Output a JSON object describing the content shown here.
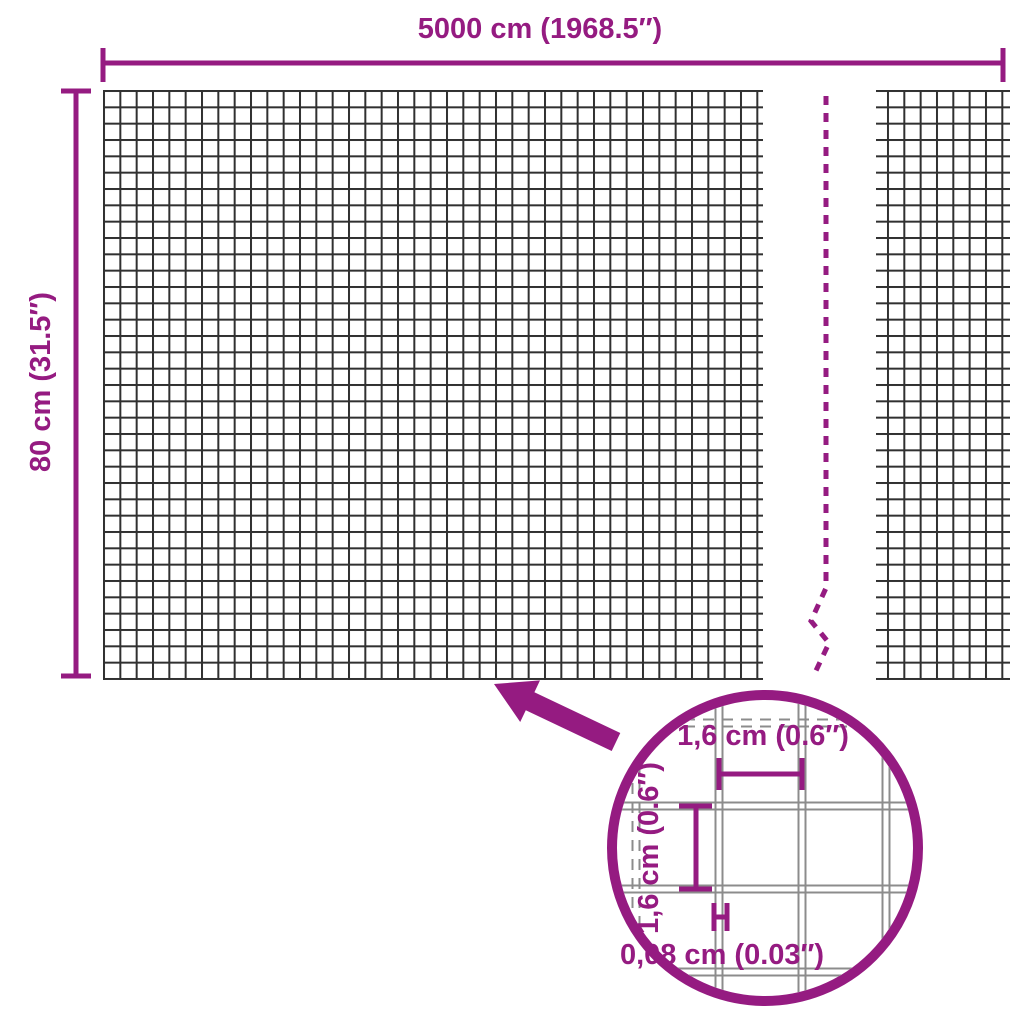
{
  "diagram": {
    "title": "wire-mesh-fence-dimension-diagram",
    "width_label": "5000 cm (1968.5″)",
    "height_label": "80 cm (31.5″)",
    "detail": {
      "mesh_width_label": "1,6 cm (0.6″)",
      "mesh_height_label": "1,6 cm (0.6″)",
      "wire_thickness_label": "0,08 cm (0.03″)"
    },
    "colors": {
      "accent_purple": "#951b81",
      "mesh_line": "#303030",
      "detail_grid_gray": "#8c8c8c",
      "background": "#ffffff"
    },
    "icons": {
      "zoom_arrow": "arrow pointing from magnifier circle to mesh",
      "break_line": "dashed continuation break line",
      "magnifier": "magnified mesh detail circle"
    }
  }
}
